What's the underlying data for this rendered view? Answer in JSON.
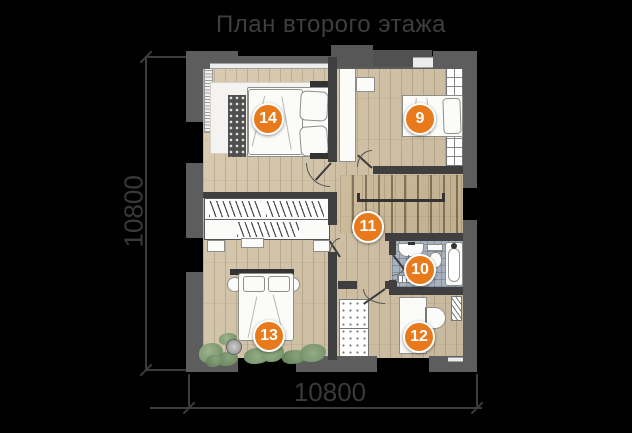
{
  "title": "План второго этажа",
  "dimensions": {
    "bottom": "10800",
    "left": "10800"
  },
  "rooms": [
    {
      "number": "14"
    },
    {
      "number": "9"
    },
    {
      "number": "11"
    },
    {
      "number": "10"
    },
    {
      "number": "13"
    },
    {
      "number": "12"
    }
  ],
  "colors": {
    "background": "#000000",
    "badge": "#e87a1c",
    "exterior_wall": "#5d5d5d",
    "interior_wall": "#3f3f3f",
    "wood_floor": "#d3c3a7",
    "bathroom_tile": "#a8b2bf",
    "annotation_text": "#3e3e3e"
  },
  "furniture_icons": [
    "double-bed",
    "single-bed",
    "wardrobe",
    "closet",
    "stairs",
    "bathtub",
    "toilet",
    "sink",
    "desk",
    "office-chair",
    "radiator",
    "plants",
    "rug",
    "quilted-cabinet",
    "nightstand",
    "pot-plant"
  ]
}
